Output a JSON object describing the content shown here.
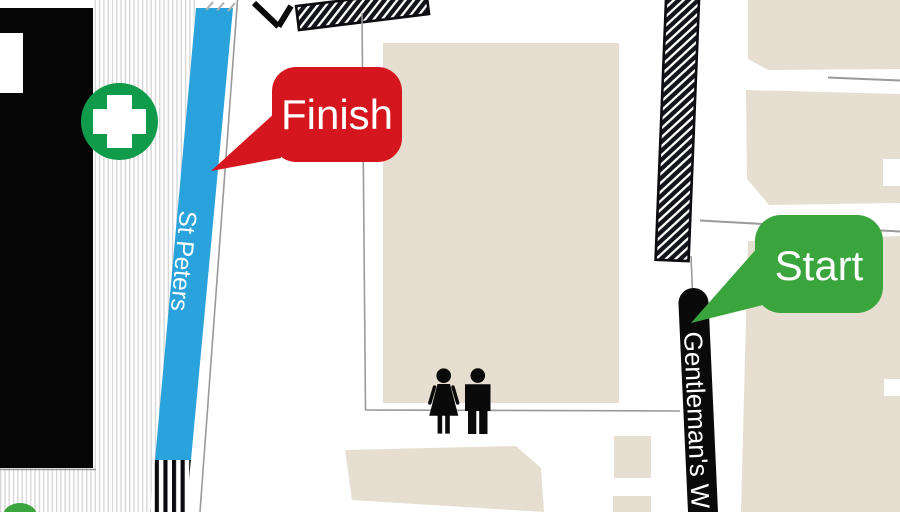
{
  "labels": {
    "finish": "Finish",
    "start": "Start"
  },
  "streets": {
    "st_peters": "St Peters",
    "gentlemans_walk": "Gentleman's W"
  },
  "icons": {
    "first_aid": "first-aid-cross-icon",
    "toilets": "toilets-icon",
    "route_arrow": "route-arrow-icon"
  },
  "colors": {
    "finish_red": "#d5161e",
    "start_green": "#3aa43d",
    "first_aid_green": "#0f9b4a",
    "road_blue": "#2aa3dc",
    "building_beige": "#e6dfd1",
    "building_black": "#060606",
    "hatch_dark": "#14141c",
    "road_black": "#0a0a0a",
    "line_gray": "#9a9a9a"
  }
}
